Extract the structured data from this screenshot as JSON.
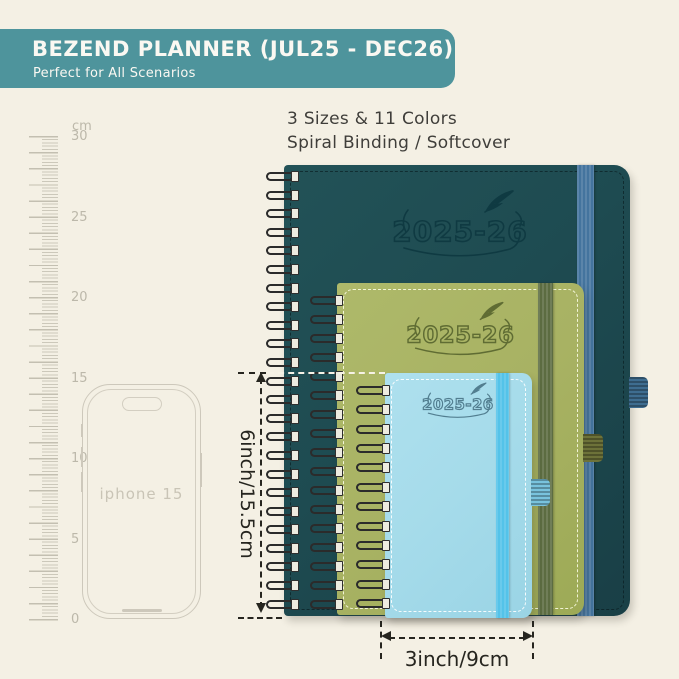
{
  "banner": {
    "title": "BEZEND PLANNER (JUL25 - DEC26)",
    "subtitle": "Perfect for All Scenarios",
    "bg_color": "#4e949c"
  },
  "features": {
    "line1": "3 Sizes & 11 Colors",
    "line2": "Spiral Binding / Softcover"
  },
  "ruler": {
    "unit": "cm",
    "tick_labels": [
      "30",
      "25",
      "20",
      "15",
      "10",
      "5",
      "0"
    ]
  },
  "phone": {
    "label": "iphone 15"
  },
  "planners": [
    {
      "id": "large-teal",
      "year_label": "2025-26",
      "cover_color": "#1e4b51",
      "band_color": "#44749e"
    },
    {
      "id": "medium-green",
      "year_label": "2025-26",
      "cover_color": "#a8b263",
      "band_color": "#5c6c41"
    },
    {
      "id": "small-blue",
      "year_label": "2025-26",
      "cover_color": "#a5dbea",
      "band_color": "#54c3e9"
    }
  ],
  "dimensions": {
    "height_label": "6inch/15.5cm",
    "width_label": "3inch/9cm"
  },
  "background_color": "#f4f0e4"
}
